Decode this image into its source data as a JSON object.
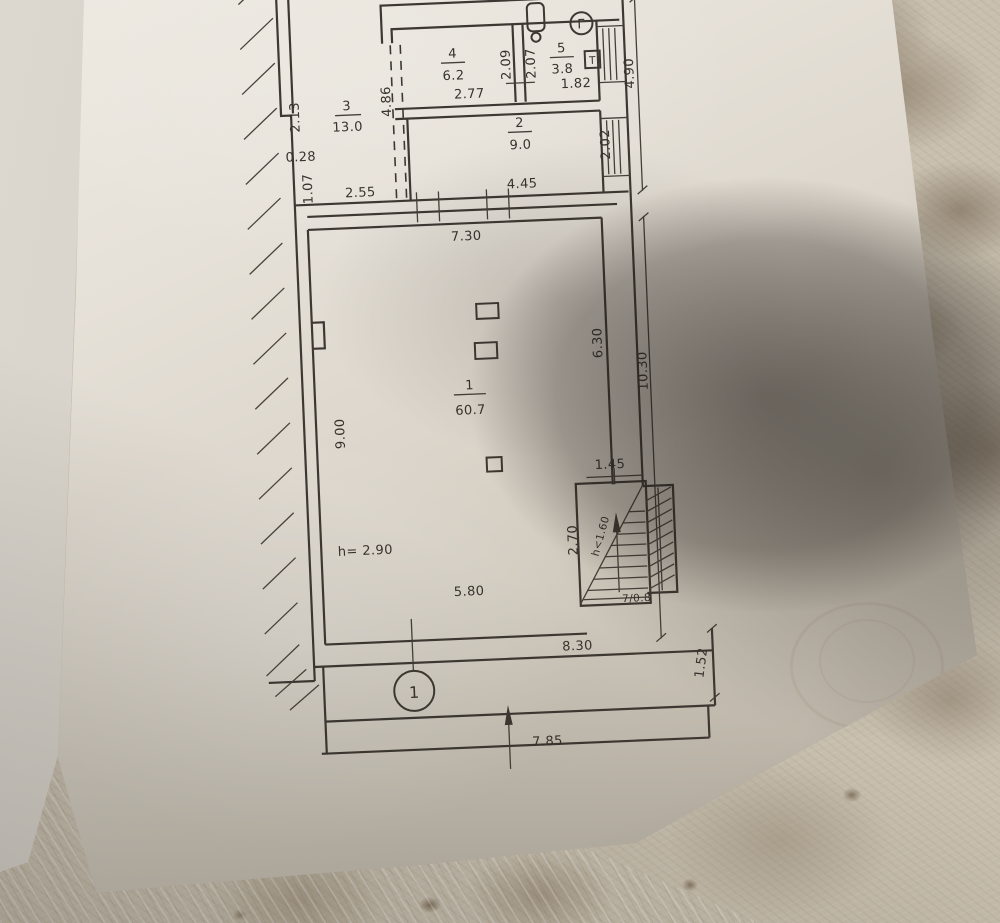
{
  "plan": {
    "rooms": [
      {
        "number": "1",
        "area": "60.7"
      },
      {
        "number": "2",
        "area": "9.0"
      },
      {
        "number": "3",
        "area": "13.0"
      },
      {
        "number": "4",
        "area": "6.2"
      },
      {
        "number": "5",
        "area": "3.8"
      }
    ],
    "dims": {
      "left_height": "2.13",
      "wall_jog": "0.28",
      "left_lower": "1.07",
      "room3_width": "2.55",
      "opening": "4.86",
      "room4_width": "2.77",
      "strip_a": "2.09",
      "strip_b": "2.07",
      "room5_width": "1.82",
      "right_upper": "4.90",
      "room2_right": "2.02",
      "room2_width": "4.45",
      "hall_top_width": "7.30",
      "hall_left_height": "9.00",
      "hall_right_upper": "6.30",
      "right_total": "10.30",
      "stair_width": "1.45",
      "stair_depth": "2.70",
      "stair_headroom": "h<1.60",
      "stair_steps": "7/0.8",
      "hall_bottom_inner": "5.80",
      "ceiling_height": "h= 2.90",
      "bottom_width": "8.30",
      "porch_right": "1.52",
      "bottom_total": "7.85"
    },
    "axis_marker": "1",
    "corner_mark": "Г",
    "wall_fixture": "Т"
  },
  "colors": {
    "ink": "#3d3832",
    "paper": "#e6e1d8",
    "tile": "#c8bfae"
  }
}
